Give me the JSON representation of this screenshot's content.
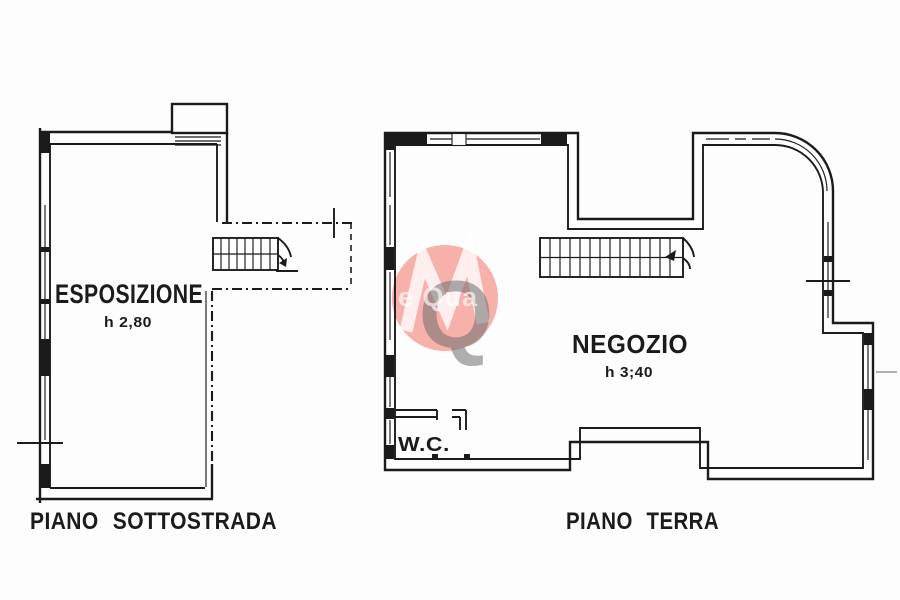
{
  "colors": {
    "line-color": "#1b1b1b",
    "wm-red": "#ee3b2e",
    "wm-gray": "#6f6f6f"
  },
  "plan_left": {
    "room_label": "ESPOSIZIONE",
    "room_height": "h 2,80",
    "floor_label": "PIANO SOTTOSTRADA"
  },
  "plan_right": {
    "room_label": "NEGOZIO",
    "room_height": "h 3;40",
    "wc_label": "W.C.",
    "floor_label": "PIANO TERRA"
  },
  "watermark": {
    "big_letter": "Q",
    "overlay_text": "e Qua"
  }
}
